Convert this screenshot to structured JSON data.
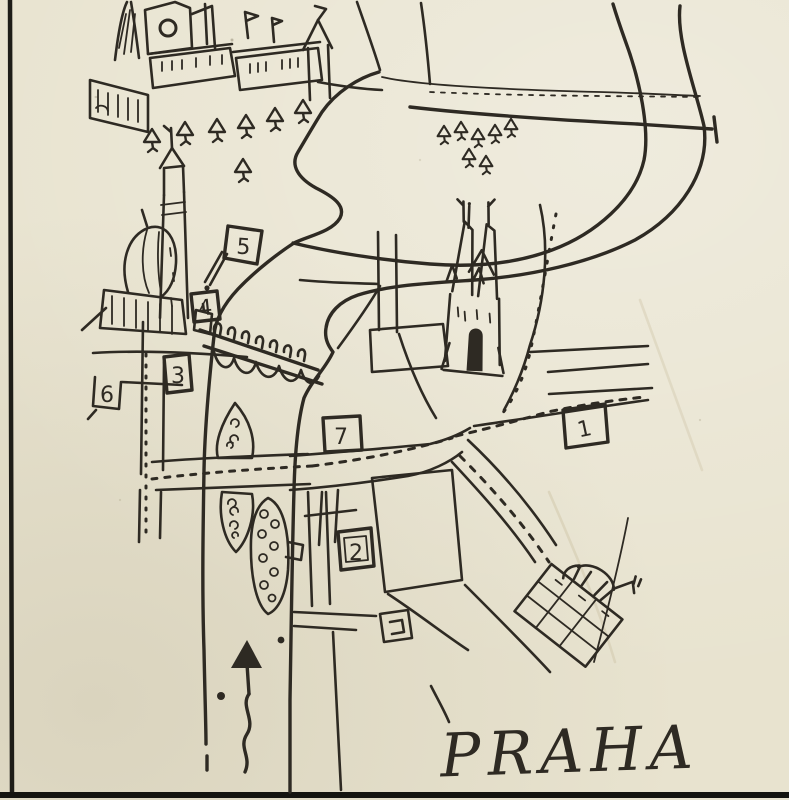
{
  "page": {
    "paper_color": "#e8e3cf",
    "ink_color": "#2e2a23",
    "border_color": "#1e1d18"
  },
  "map": {
    "title": "PRAHA",
    "markers": [
      {
        "label": "1"
      },
      {
        "label": "2"
      },
      {
        "label": "3"
      },
      {
        "label": "4"
      },
      {
        "label": "5"
      },
      {
        "label": "6"
      },
      {
        "label": "7"
      }
    ],
    "icons": [
      "prague-castle-illustration",
      "evergreen-tree-icon",
      "church-tower-and-dome-icon",
      "flag-marker-icon",
      "bridge-with-statues-icon",
      "gothic-cathedral-icon",
      "river-island-icon",
      "equestrian-statue-and-museum-icon",
      "north-arrow-icon"
    ]
  }
}
